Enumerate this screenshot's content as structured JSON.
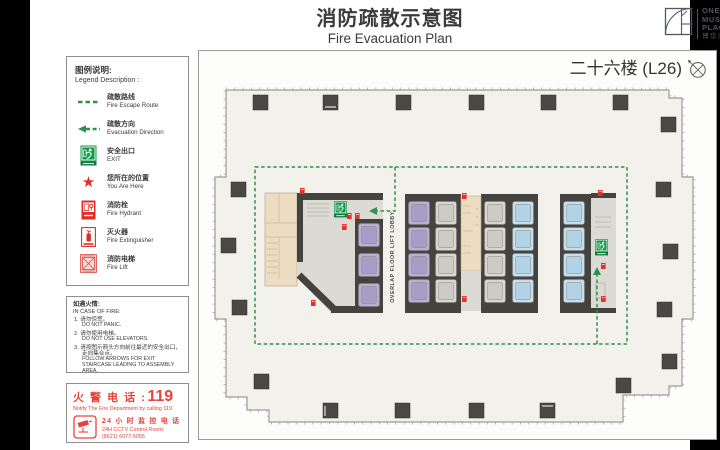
{
  "header": {
    "title_zh": "消防疏散示意图",
    "title_en": "Fire Evacuation Plan"
  },
  "logo": {
    "line1": "ONE",
    "line2": "MUSEUM",
    "line3": "PLACE",
    "subtitle_zh": "博华广场"
  },
  "plan": {
    "floor_label": "二十六楼 (L26)",
    "lift_lobby_label": "OVERLAP FLOOR LIFT LOBBY"
  },
  "legend": {
    "heading_zh": "图例说明:",
    "heading_en": "Legend Description :",
    "items": [
      {
        "icon": "fire-escape-route-icon",
        "zh": "疏散路线",
        "en": "Fire Escape Route"
      },
      {
        "icon": "evacuation-direction-icon",
        "zh": "疏散方向",
        "en": "Evacuation Direction"
      },
      {
        "icon": "exit-sign-icon",
        "zh": "安全出口",
        "en": "EXIT"
      },
      {
        "icon": "you-are-here-star-icon",
        "zh": "您所在的位置",
        "en": "You Are Here"
      },
      {
        "icon": "fire-hydrant-icon",
        "zh": "消防栓",
        "en": "Fire Hydrant"
      },
      {
        "icon": "fire-extinguisher-icon",
        "zh": "灭火器",
        "en": "Fire Extinguisher"
      },
      {
        "icon": "fire-lift-icon",
        "zh": "消防电梯",
        "en": "Fire Lift"
      }
    ]
  },
  "fire_case": {
    "heading_zh": "如遇火情:",
    "heading_en": "IN CASE OF FIRE:",
    "items": [
      {
        "zh": "1. 请勿惊慌。",
        "en": "DO NOT PANIC."
      },
      {
        "zh": "2. 请勿使用电梯。",
        "en": "DO NOT USE ELEVATORS."
      },
      {
        "zh": "3. 请按图示箭头方向前往最近的安全出口，走向集合点。",
        "en": "FOLLOW ARROWS FOR EXIT STAIRCASE LEADING TO ASSEMBLY AREA."
      }
    ]
  },
  "fire_phone": {
    "label_zh": "火 警 电 话 :",
    "number": "119",
    "note": "Notify The Fire Department by calling 119",
    "cctv_zh": "24 小 时 监 控 电 话",
    "cctv_en": "24H CCTV Control Room:",
    "cctv_tel": "(8621) 6077-5055"
  },
  "colors": {
    "route_green": "#2f9150",
    "exit_green": "#16984b",
    "alert_red": "#e03228",
    "phone_red": "#e8423b"
  }
}
